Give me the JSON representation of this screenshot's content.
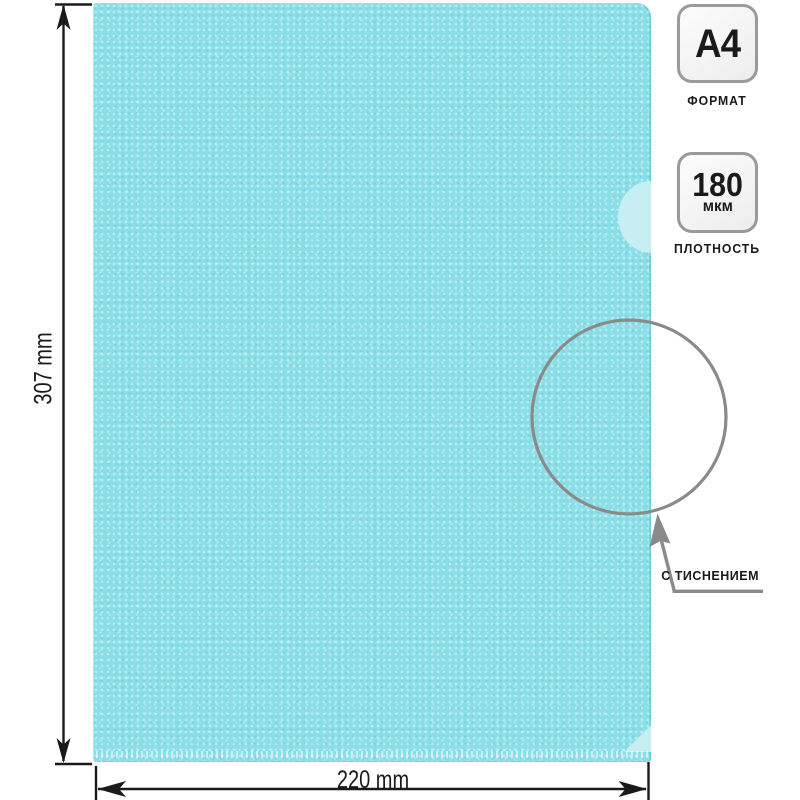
{
  "dimensions": {
    "height": "307 mm",
    "width": "220 mm"
  },
  "badges": {
    "format": {
      "value": "A4",
      "label": "ФОРМАТ"
    },
    "density": {
      "value": "180",
      "unit": "мкм",
      "label": "ПЛОТНОСТЬ"
    }
  },
  "callout": {
    "label": "С ТИСНЕНИЕМ"
  },
  "colors": {
    "folder": "#8ADEE7",
    "folder_light": "#C6EEF3",
    "ink": "#1A1A1A",
    "gray": "#8A8A8A",
    "badge_bg": "#EDEDED",
    "badge_border": "#9A9A9A"
  }
}
